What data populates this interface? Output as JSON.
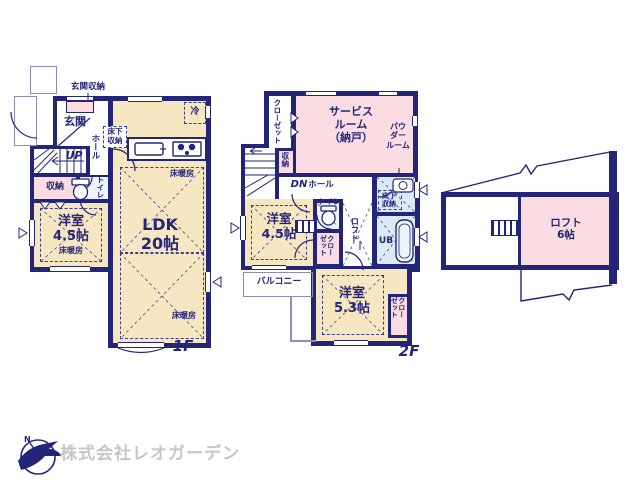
{
  "colors": {
    "wall_navy": "#232578",
    "room_cream": "#f7e6c2",
    "room_pink": "#fadce2",
    "room_blue": "#dce9f6",
    "room_blue_light": "#edf4fc",
    "thin_line": "#8a8ebc",
    "footer_gray": "#c6c6c6"
  },
  "floor1": {
    "floor_label": "1F",
    "entrance_storage": "玄関収納",
    "entrance": "玄関",
    "up": "UP",
    "hall": "ホール",
    "underfloor_storage": "床下\n収納",
    "fridge": "冷",
    "toilet": "トイレ",
    "storage": "収納",
    "bedroom": "洋室\n4.5帖",
    "floor_heating": "床暖房",
    "ldk": "LDK\n20帖"
  },
  "floor2": {
    "floor_label": "2F",
    "closet_top": "クローゼット",
    "service_room": "サービス\nルーム\n（納戸）",
    "powder_room": "パウ\nダー\nルーム",
    "storage": "収納",
    "dn": "DN",
    "hall": "ホール",
    "toilet": "トイレ",
    "underfloor_storage": "床下\n収納",
    "unit_bath": "UB",
    "loft_access": "ロフト",
    "closet_mid": "クロー\nゼット",
    "bedroom_45": "洋室\n4.5帖",
    "balcony": "バルコニー",
    "bedroom_53": "洋室\n5.3帖",
    "closet_right": "クロー\nゼット"
  },
  "loft": {
    "label": "ロフト\n6帖"
  },
  "footer": {
    "company": "株式会社レオガーデン"
  }
}
